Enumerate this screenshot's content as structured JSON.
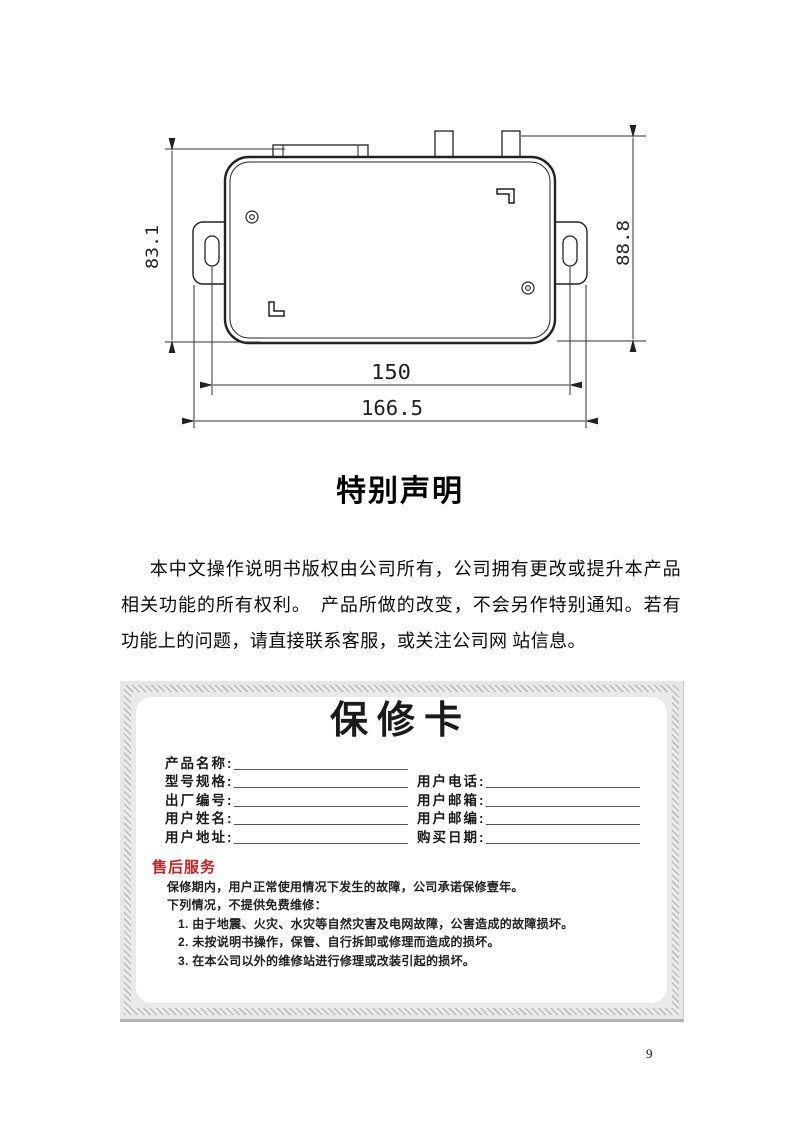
{
  "page": {
    "number": "9"
  },
  "drawing": {
    "dims": {
      "height_left": "83.1",
      "height_right": "88.8",
      "width_inner": "150",
      "width_outer": "166.5"
    }
  },
  "statement": {
    "title": "特别声明",
    "body": "本中文操作说明书版权由公司所有，公司拥有更改或提升本产品相关功能的所有权利。　产品所做的改变，不会另作特别通知。若有功能上的问题，请直接联系客服，或关注公司网 站信息。"
  },
  "warranty_card": {
    "title": "保修卡",
    "rows": [
      {
        "left": "产品名称:",
        "right": ""
      },
      {
        "left": "型号规格:",
        "right": "用户电话:"
      },
      {
        "left": "出厂编号:",
        "right": "用户邮箱:"
      },
      {
        "left": "用户姓名:",
        "right": "用户邮编:"
      },
      {
        "left": "用户地址:",
        "right": "购买日期:"
      }
    ],
    "service": {
      "heading": "售后服务",
      "heading_color": "#cc2222",
      "intro_lines": [
        "保修期内，用户正常使用情况下发生的故障，公司承诺保修壹年。",
        "下列情况，不提供免费维修："
      ],
      "items": [
        "1. 由于地震、火灾、水灾等自然灾害及电网故障，公害造成的故障损坏。",
        "2. 未按说明书操作，保管、自行拆卸或修理而造成的损坏。",
        "3. 在本公司以外的维修站进行修理或改装引起的损坏。"
      ]
    }
  }
}
